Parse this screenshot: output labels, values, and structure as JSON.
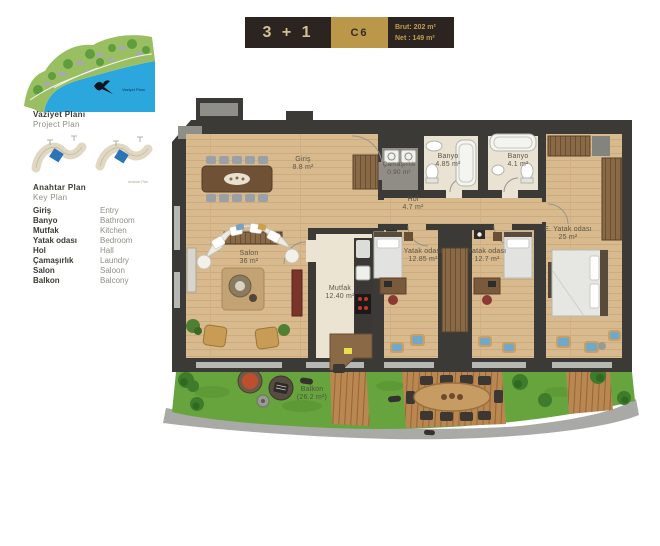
{
  "header": {
    "type_label": "3 + 1",
    "unit_code": "C6",
    "brut": "Brut: 202 m²",
    "net": "Net : 149 m²"
  },
  "sidebar": {
    "project_plan_title_tr": "Vaziyet Planı",
    "project_plan_title_en": "Project Plan",
    "key_plan_title_tr": "Anahtar Plan",
    "key_plan_title_en": "Key Plan",
    "legend": [
      {
        "tr": "Giriş",
        "en": "Entry"
      },
      {
        "tr": "Banyo",
        "en": "Bathroom"
      },
      {
        "tr": "Mutfak",
        "en": "Kitchen"
      },
      {
        "tr": "Yatak odası",
        "en": "Bedroom"
      },
      {
        "tr": "Hol",
        "en": "Hall"
      },
      {
        "tr": "Çamaşırlık",
        "en": "Laundry"
      },
      {
        "tr": "Salon",
        "en": "Saloon"
      },
      {
        "tr": "Balkon",
        "en": "Balcony"
      }
    ]
  },
  "floorplan": {
    "rooms": [
      {
        "name": "Giriş",
        "area": "8.8 m²"
      },
      {
        "name": "Çamaşırlık",
        "area": "0.90 m²"
      },
      {
        "name": "Banyo",
        "area": "4.85 m²"
      },
      {
        "name": "Banyo",
        "area": "4.1 m²"
      },
      {
        "name": "Hol",
        "area": "4.7 m²"
      },
      {
        "name": "Salon",
        "area": "36 m²"
      },
      {
        "name": "Mutfak",
        "area": "12.40 m²"
      },
      {
        "name": "Yatak odası",
        "area": "12.85 m²"
      },
      {
        "name": "Yatak odası",
        "area": "12.7 m²"
      },
      {
        "name": "E. Yatak odası",
        "area": "25 m²"
      },
      {
        "name": "Balkon",
        "area": "(26.2 m²)"
      }
    ]
  },
  "colors": {
    "accent_gold": "#bb974a",
    "header_dark": "#2b2420",
    "wall": "#3b3a37",
    "wood_floor": "#d8ba8e",
    "grass": "#68a43d",
    "sea": "#2ba7dd"
  }
}
